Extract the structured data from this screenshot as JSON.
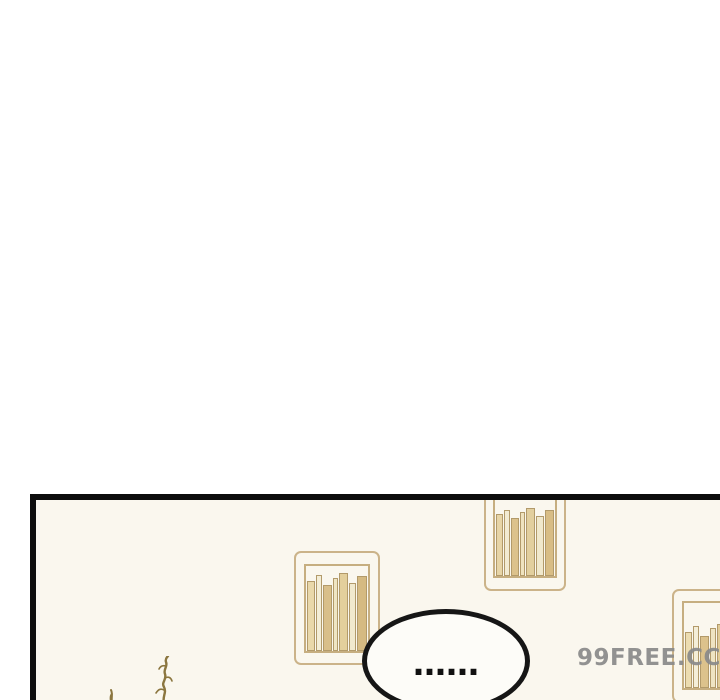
{
  "page": {
    "background": "#ffffff"
  },
  "panel": {
    "background": "#faf7ee",
    "border_color": "#0d0d0d"
  },
  "speech_bubble": {
    "text": "……",
    "fill": "#fdfcf8",
    "stroke": "#161616"
  },
  "watermark": {
    "text": "99FREE.CC",
    "color": "#8a8a8a"
  },
  "decor": {
    "frame_color": "#cbb389",
    "inner_color": "#c6ae80",
    "book_outline": "#b29a6a",
    "plant_color": "#8b763f",
    "shelves": [
      {
        "name": "bookshelf-top",
        "left": 448,
        "top": -14,
        "width": 82,
        "height": 105,
        "inner": {
          "left": 9,
          "right": 9,
          "top": 10,
          "bottom": 13
        },
        "books": [
          {
            "w": 8,
            "h": 62,
            "c": "#e7d5a7"
          },
          {
            "w": 6,
            "h": 66,
            "c": "#f2ebd3"
          },
          {
            "w": 9,
            "h": 58,
            "c": "#dcc28c"
          },
          {
            "w": 5,
            "h": 64,
            "c": "#efe3bf"
          },
          {
            "w": 10,
            "h": 68,
            "c": "#e2cf9e"
          },
          {
            "w": 8,
            "h": 60,
            "c": "#f0e8cc"
          },
          {
            "w": 10,
            "h": 66,
            "c": "#d8bd85"
          }
        ]
      },
      {
        "name": "bookshelf-middle",
        "left": 258,
        "top": 51,
        "width": 86,
        "height": 114,
        "inner": {
          "left": 10,
          "right": 10,
          "top": 13,
          "bottom": 12
        },
        "books": [
          {
            "w": 9,
            "h": 70,
            "c": "#e9d8aa"
          },
          {
            "w": 6,
            "h": 76,
            "c": "#f3edd6"
          },
          {
            "w": 10,
            "h": 66,
            "c": "#d9bf8a"
          },
          {
            "w": 6,
            "h": 73,
            "c": "#efe5c4"
          },
          {
            "w": 9,
            "h": 78,
            "c": "#e3cf9c"
          },
          {
            "w": 8,
            "h": 68,
            "c": "#f1e9cd"
          },
          {
            "w": 11,
            "h": 75,
            "c": "#d5ba82"
          }
        ]
      },
      {
        "name": "bookshelf-right",
        "left": 636,
        "top": 89,
        "width": 86,
        "height": 114,
        "inner": {
          "left": 10,
          "right": 10,
          "top": 12,
          "bottom": 13
        },
        "books": [
          {
            "w": 8,
            "h": 56,
            "c": "#ecdcb0"
          },
          {
            "w": 6,
            "h": 62,
            "c": "#f4eed8"
          },
          {
            "w": 10,
            "h": 52,
            "c": "#dcc28c"
          },
          {
            "w": 7,
            "h": 60,
            "c": "#efe4c2"
          },
          {
            "w": 10,
            "h": 64,
            "c": "#e0cb96"
          },
          {
            "w": 9,
            "h": 57,
            "c": "#f0e8cc"
          },
          {
            "w": 10,
            "h": 62,
            "c": "#d7bc84"
          }
        ]
      }
    ]
  }
}
